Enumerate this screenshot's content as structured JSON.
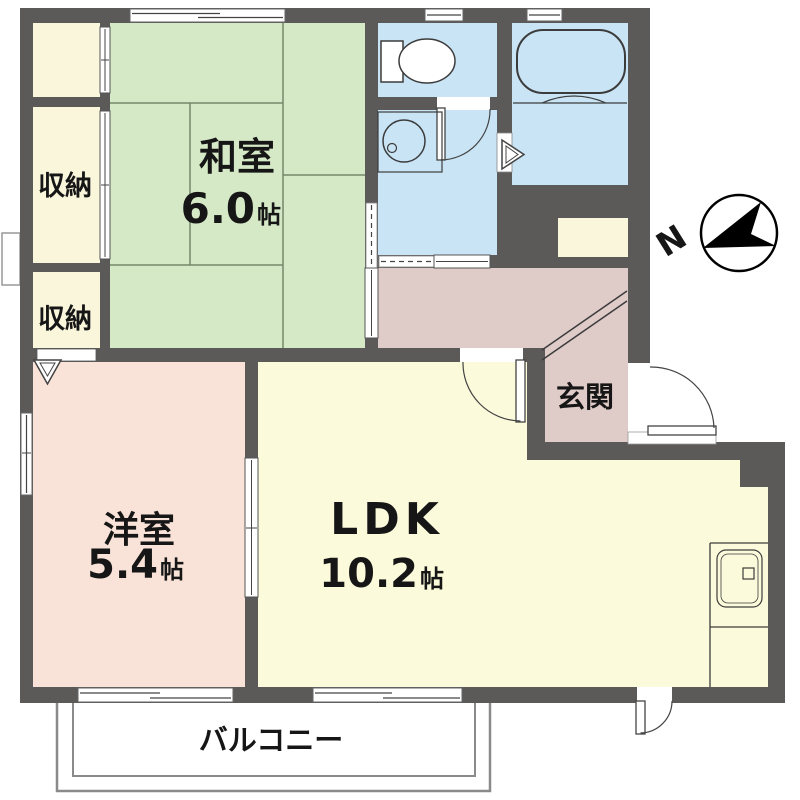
{
  "plan": {
    "type": "japanese-apartment-floorplan",
    "rooms": {
      "washitsu": {
        "name": "和室",
        "size_value": "6.0",
        "size_unit": "帖"
      },
      "youshitsu": {
        "name": "洋室",
        "size_value": "5.4",
        "size_unit": "帖"
      },
      "ldk": {
        "name": "LDK",
        "size_value": "10.2",
        "size_unit": "帖"
      },
      "genkan": {
        "name": "玄関"
      },
      "storage_mid": {
        "name": "収納"
      },
      "storage_low": {
        "name": "収納"
      },
      "balcony": {
        "name": "バルコニー"
      }
    },
    "compass": {
      "north": "N"
    },
    "colors": {
      "wall": "#5c5959",
      "tatami_room": "#d5e9c7",
      "storage": "#faf6dc",
      "western_room": "#f9e2d7",
      "ldk": "#fbfada",
      "wet_area": "#c9e4f5",
      "hall_genkan": "#dfcbc8",
      "fixture_outline": "#3c3c3c",
      "balcony_line": "#8a8a8a"
    }
  }
}
